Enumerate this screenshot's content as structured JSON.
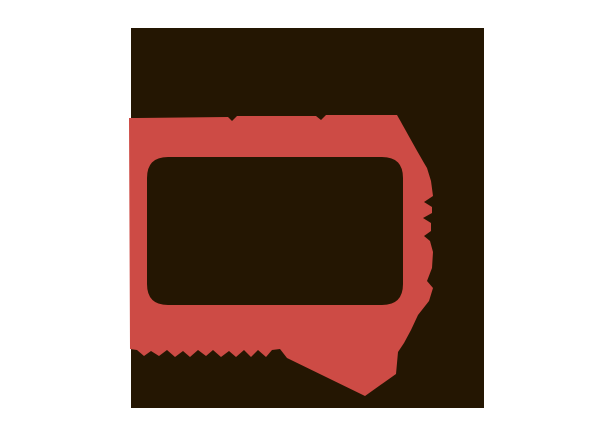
{
  "window": {
    "width": 614,
    "height": 437,
    "background_color": "#ffffff"
  },
  "logo": {
    "name": "distressed-frame-emblem",
    "description": "Coral-red distressed rounded TV-frame / speech-bubble emblem with a dark inner window, illegible knocked-out lettering along its lower edge, distress slits on the right edge, and a sweeping brush tail pointing down-right, all over a centered dark-brown rectangular backdrop on white",
    "backdrop_color": "#241602",
    "accent_color": "#cd4b45",
    "backdrop_rect": {
      "x": 131,
      "y": 28,
      "width": 353,
      "height": 380
    }
  }
}
